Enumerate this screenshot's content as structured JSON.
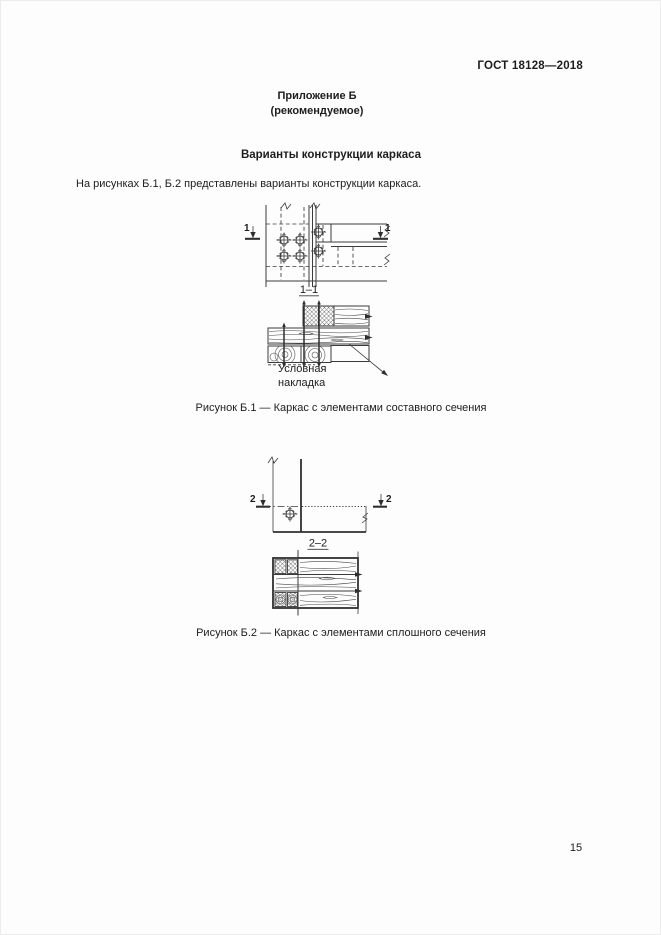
{
  "page": {
    "header_code": "ГОСТ 18128—2018",
    "appendix": {
      "title": "Приложение Б",
      "subtitle": "(рекомендуемое)"
    },
    "section_title": "Варианты конструкции каркаса",
    "intro_text": "На рисунках Б.1, Б.2 представлены варианты конструкции каркаса.",
    "page_number": "15"
  },
  "figure_b1": {
    "cut_mark_left": "1",
    "cut_mark_right": "1",
    "section_label": "1–1",
    "callout": "Условная накладка",
    "caption": "Рисунок Б.1 — Каркас с элементами составного сечения"
  },
  "figure_b2": {
    "cut_mark_left": "2",
    "cut_mark_right": "2",
    "section_label": "2–2",
    "caption": "Рисунок Б.2 — Каркас с элементами сплошного сечения"
  },
  "colors": {
    "ink": "#3b3b3b",
    "paper": "#fdfdfd"
  }
}
